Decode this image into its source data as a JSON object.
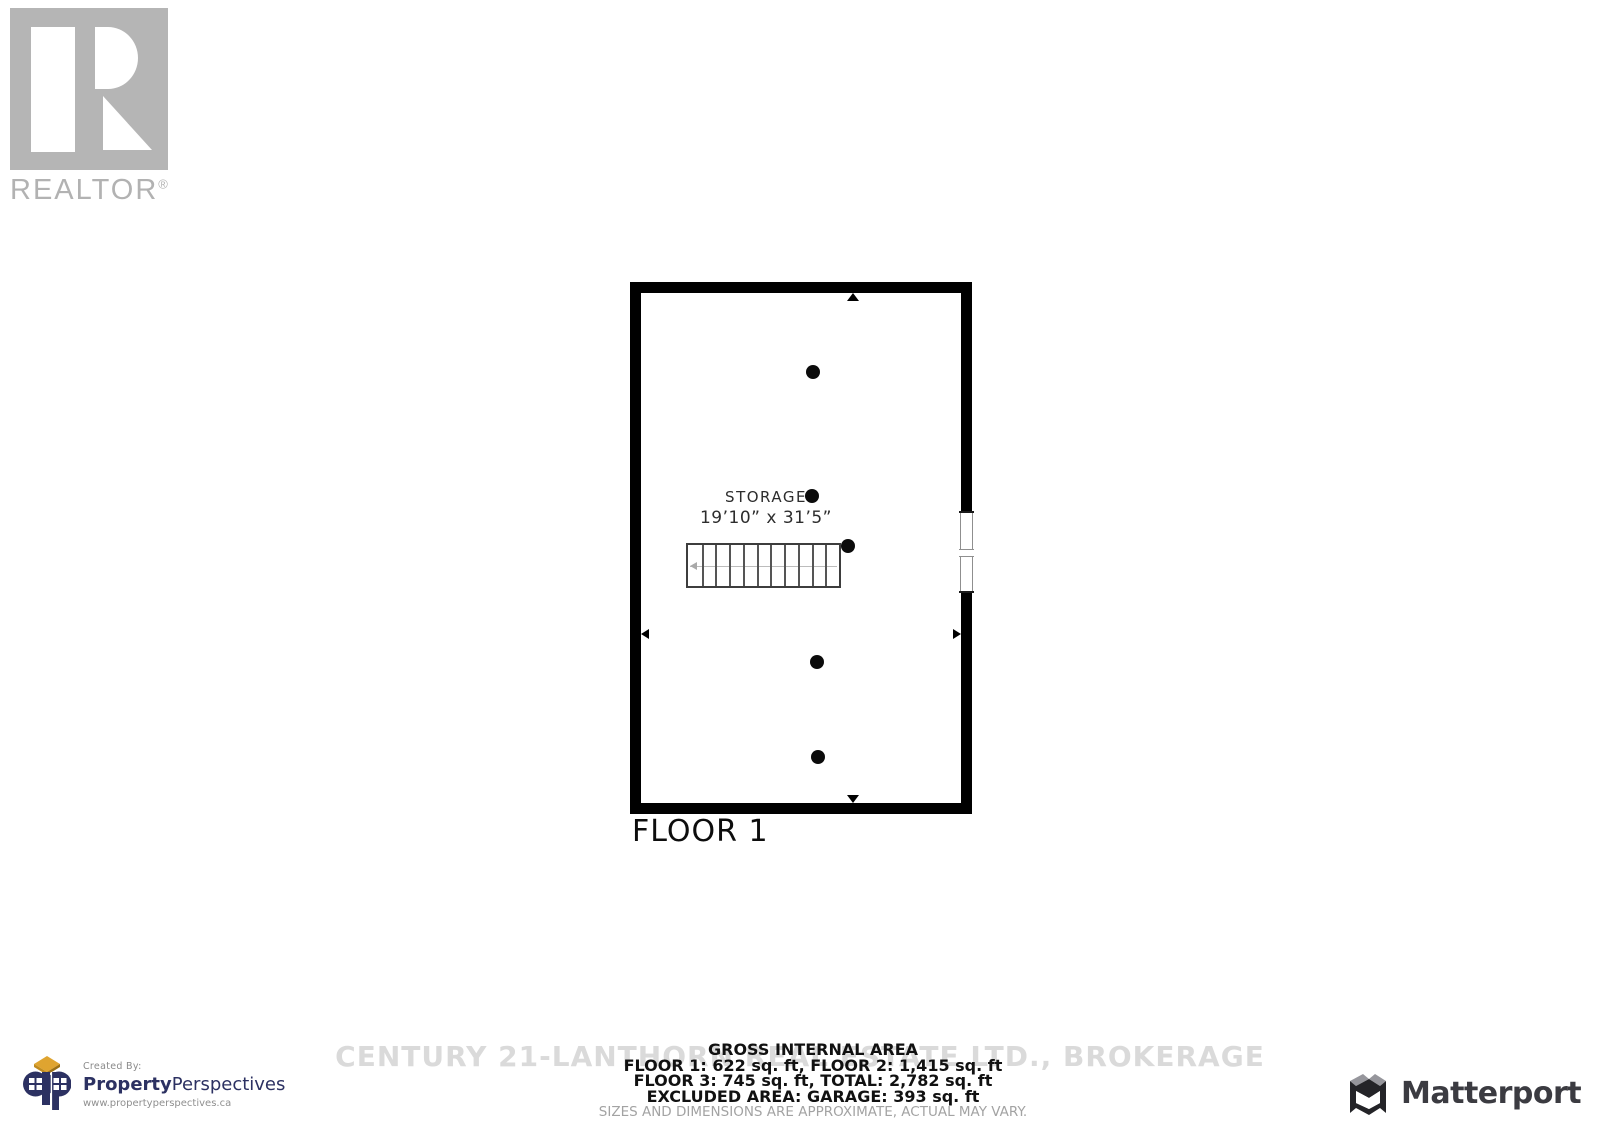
{
  "realtor_badge": {
    "word": "REALTOR",
    "registered": "®"
  },
  "floorplan": {
    "room_label": "STORAGE",
    "room_dims": "19’10” x 31’5”",
    "floor_label": "FLOOR 1",
    "stairs": {
      "treads": 11
    },
    "columns": [
      {
        "x": 172,
        "y": 79
      },
      {
        "x": 171,
        "y": 203
      },
      {
        "x": 207,
        "y": 253
      },
      {
        "x": 176,
        "y": 369
      },
      {
        "x": 177,
        "y": 464
      }
    ],
    "arrows": [
      {
        "dir": "up",
        "left": 206,
        "top": 0
      },
      {
        "dir": "down",
        "left": 206,
        "top": 502
      },
      {
        "dir": "left",
        "left": 0,
        "top": 336
      },
      {
        "dir": "right",
        "left": 312,
        "top": 336
      }
    ]
  },
  "footer": {
    "watermark": "CENTURY 21-LANTHORN REAL ESTATE LTD., BROKERAGE",
    "title": "GROSS INTERNAL AREA",
    "line1": "FLOOR 1: 622 sq. ft, FLOOR 2: 1,415 sq. ft",
    "line2": "FLOOR 3: 745 sq. ft, TOTAL: 2,782 sq. ft",
    "line3": "EXCLUDED AREA: GARAGE: 393 sq. ft",
    "disclaimer": "SIZES AND DIMENSIONS ARE APPROXIMATE, ACTUAL MAY VARY."
  },
  "credits": {
    "created_by": "Created By:",
    "brand_bold": "Property",
    "brand_rest": "Perspectives",
    "url": "www.propertyperspectives.ca",
    "matterport": "Matterport"
  }
}
